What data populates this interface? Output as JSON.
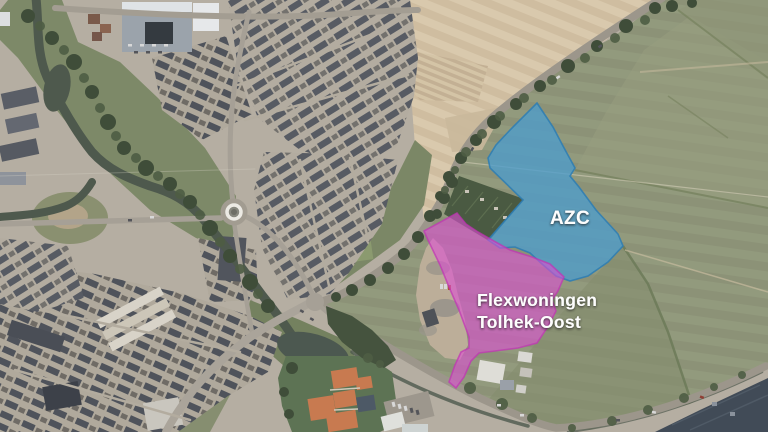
{
  "map": {
    "type": "aerial-photograph",
    "annotations": [
      {
        "id": "azc",
        "label": "AZC",
        "zone_fill": "#4d9ccc",
        "zone_stroke": "#2d7db3",
        "label_color": "#fdfdfd"
      },
      {
        "id": "flexwoningen-tolhek-oost",
        "label": "Flexwoningen Tolhek-Oost",
        "label_line1": "Flexwoningen",
        "label_line2": "Tolhek-Oost",
        "zone_fill": "#de4fd3",
        "zone_stroke": "#c133b4",
        "label_color": "#fdfdfd"
      }
    ],
    "terrain_colors": {
      "urban": "#b5aea2",
      "fields": "#8c9277",
      "plowed_field": "#cfbda0",
      "water": "#4e594d",
      "roads": "#a6a096",
      "tennis_courts": "#c87a50"
    }
  }
}
